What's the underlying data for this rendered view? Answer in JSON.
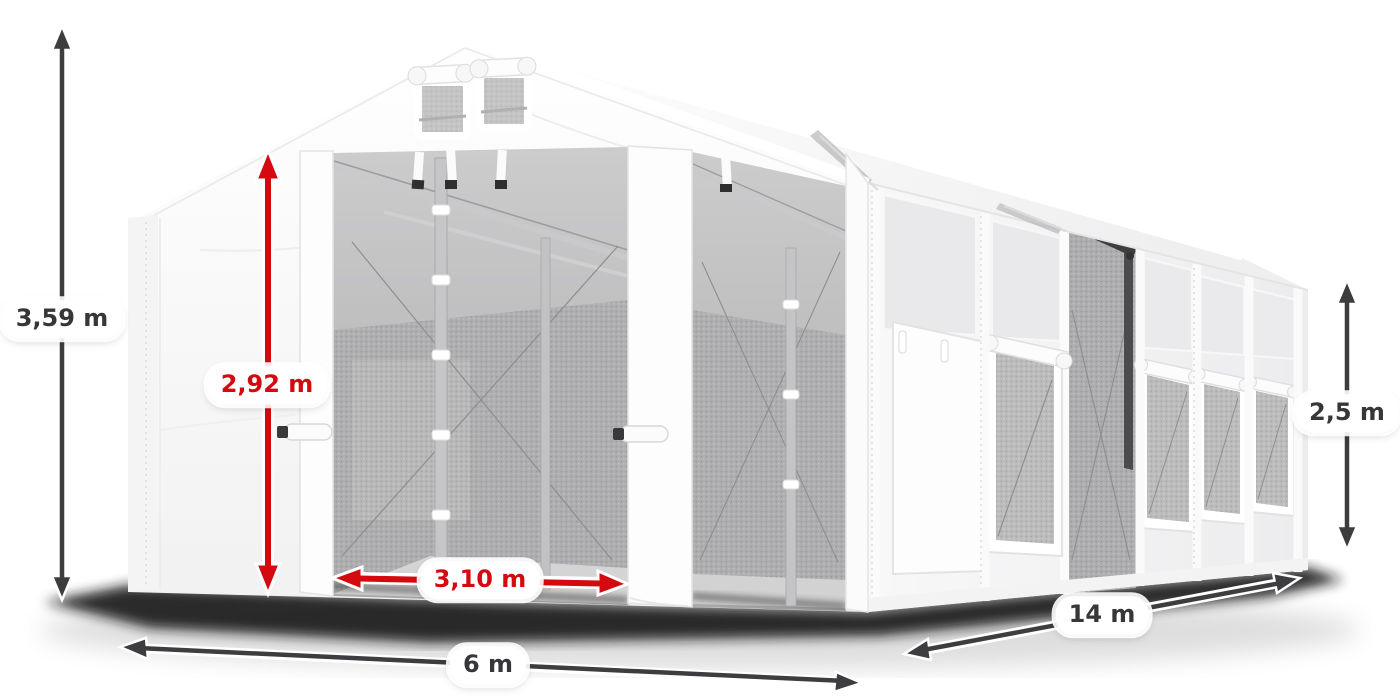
{
  "background_color": "#ffffff",
  "annotations": {
    "total_height": {
      "label": "3,59 m",
      "arrow_color": "#3d3d40",
      "text_color": "#37373a",
      "icon": "double-headed-arrow-vertical"
    },
    "door_height": {
      "label": "2,92 m",
      "arrow_color": "#d40a10",
      "text_color": "#d40a10",
      "icon": "double-headed-arrow-vertical"
    },
    "door_width": {
      "label": "3,10 m",
      "arrow_color": "#d40a10",
      "text_color": "#d40a10",
      "icon": "double-headed-arrow-horizontal"
    },
    "front_width": {
      "label": "6 m",
      "arrow_color": "#3d3d40",
      "text_color": "#37373a",
      "icon": "double-headed-arrow-horizontal"
    },
    "side_length": {
      "label": "14 m",
      "arrow_color": "#3d3d40",
      "text_color": "#37373a",
      "icon": "double-headed-arrow-diagonal"
    },
    "side_wall_height": {
      "label": "2,5 m",
      "arrow_color": "#3d3d40",
      "text_color": "#37373a",
      "icon": "double-headed-arrow-vertical"
    }
  },
  "illustration_colors": {
    "tent_fabric": "#ffffff",
    "tent_shading": "#f2f2f3",
    "interior_mesh": "#b7b7b8",
    "frame_silver": "#c6c6c8",
    "ground_shadow": "#141414"
  }
}
